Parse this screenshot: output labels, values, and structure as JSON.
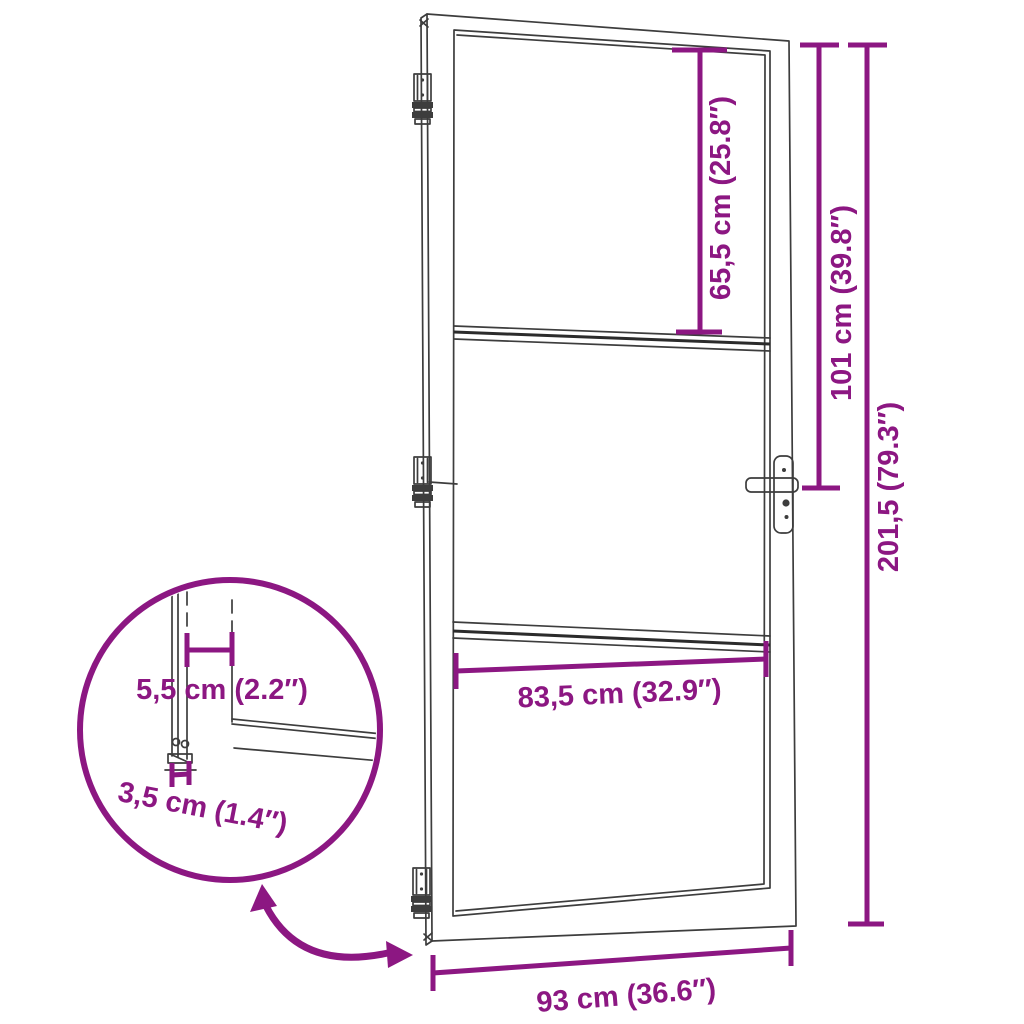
{
  "figure": {
    "accent_color": "#8C1782",
    "line_color": "#3d3d3d",
    "dimensions": {
      "glass_top_height": "65,5 cm (25.8″)",
      "handle_height": "101 cm (39.8″)",
      "door_height": "201,5 (79.3″)",
      "glass_width": "83,5 cm (32.9″)",
      "door_width": "93 cm (36.6″)",
      "profile_face_width": "5,5 cm (2.2″)",
      "profile_thickness": "3,5 cm (1.4″)"
    }
  }
}
